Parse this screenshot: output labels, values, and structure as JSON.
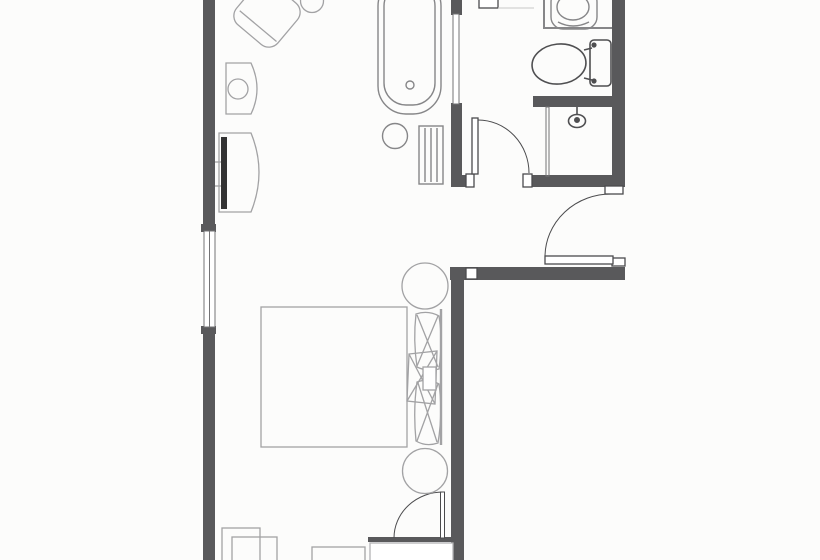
{
  "meta": {
    "content_type": "architectural-floor-plan",
    "subject": "hotel-guestroom-with-bathroom",
    "visible_text": []
  },
  "colors": {
    "background": "#fcfcfb",
    "white": "#ffffff",
    "wall": "#59595b",
    "door_line": "#4b4b4d",
    "glass_line": "#737375",
    "fixture_line": "#868688",
    "sanitary_line": "#4f4f51",
    "furniture_line": "#a2a2a4",
    "faint_line": "#c7c7c7",
    "tv_screen": "#333333"
  },
  "rooms": [
    {
      "id": "bedroom",
      "position": "lower-left"
    },
    {
      "id": "bathroom",
      "position": "top-right"
    },
    {
      "id": "entry-hall",
      "position": "right"
    },
    {
      "id": "closet",
      "position": "bottom-right"
    }
  ],
  "fixtures": [
    "bathtub",
    "tub-drain",
    "tub-stool",
    "towel-rack",
    "glass-partition",
    "vanity-counter",
    "sink",
    "toilet",
    "shower",
    "shower-head"
  ],
  "furniture": [
    "armchair",
    "round-side-table",
    "lamp-cabinet",
    "table-lamp",
    "tv-dresser",
    "tv-screen",
    "bed",
    "blanket",
    "pillow",
    "center-cushion",
    "round-nightstand-top",
    "round-nightstand-bottom",
    "side-table-a",
    "side-table-b",
    "bench",
    "closet-box"
  ],
  "openings": [
    "left-window",
    "bathroom-door",
    "entry-door",
    "closet-door",
    "top-doorway-jamb"
  ]
}
